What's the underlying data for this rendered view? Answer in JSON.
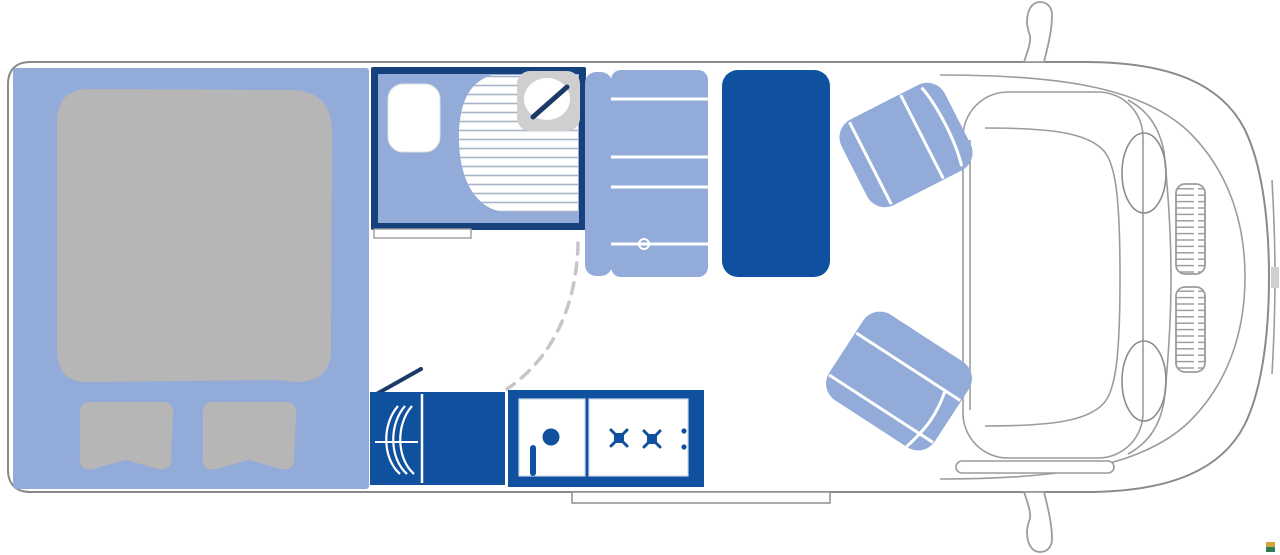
{
  "colors": {
    "white": "#ffffff",
    "body_outline": "#8a8a8a",
    "cab_line": "#9c9c9c",
    "wheel_line": "#8b8b8b",
    "floor_light_blue": "#92abd8",
    "furniture_navy": "#10519f",
    "bathroom_wall_navy": "#17417d",
    "door_line_navy": "#1c3a66",
    "soft_gray": "#b6b6b6",
    "basin_gray": "#cfcfcf",
    "shower_stripe": "#a8b4ca",
    "panel_edge": "#c9d6ea",
    "dashed_arc_gray": "#c6c6c6",
    "step_outline": "#8f8f8f",
    "plate_gray": "#cfcfcf"
  },
  "watermark": {
    "top_color": "#d4a43c",
    "bottom_color": "#2e7d52"
  },
  "floorplan_elements": [
    "double-bed",
    "pillows",
    "bathroom",
    "toilet",
    "shower",
    "washbasin",
    "bench-seat",
    "dinette-table",
    "heater",
    "kitchen-cabinet",
    "kitchen-sink",
    "gas-hob",
    "entry-step",
    "entry-door",
    "door-swing-arc",
    "cab-seat-top",
    "cab-seat-bottom",
    "side-mirror-top",
    "side-mirror-bottom"
  ]
}
